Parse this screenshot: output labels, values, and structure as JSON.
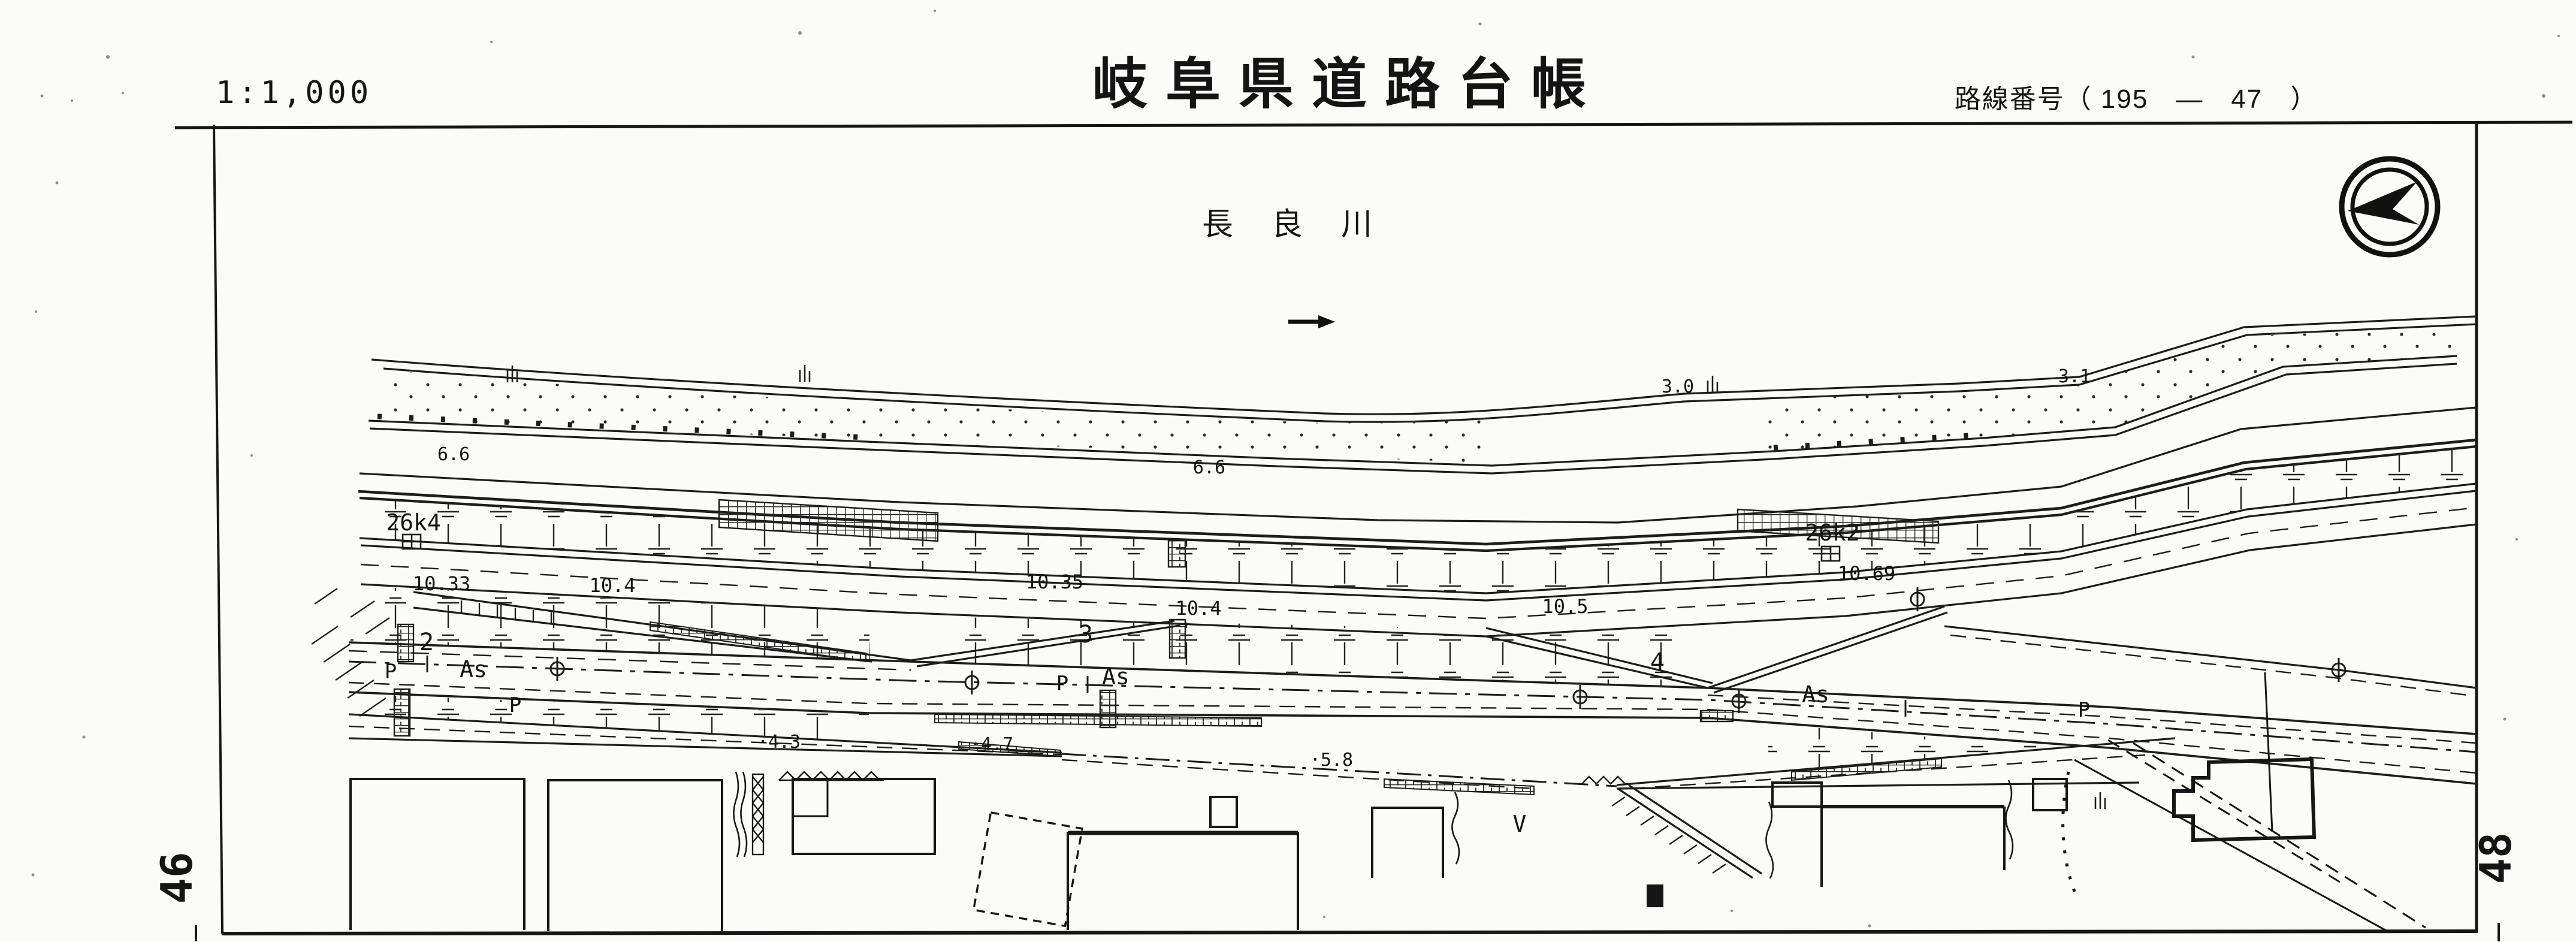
{
  "header": {
    "scale": "1:1,000",
    "title": "岐阜県道路台帳",
    "route_number": "路線番号（ 195　—　47　）"
  },
  "map": {
    "river_name": "長良川",
    "flow_arrow": "→",
    "compass": "north-west-pointer",
    "km_posts": [
      "26k4",
      "26k2"
    ],
    "road_widths": [
      "10.33",
      "10.4",
      "10.35",
      "10.4",
      "10.5",
      "10.69"
    ],
    "spot_elevations": [
      "3.0",
      "3.1",
      "6.6",
      "6.6",
      "·4.3",
      "·4.7",
      "·5.8"
    ],
    "ramp_numbers": [
      "2",
      "3",
      "4"
    ],
    "surface_labels": [
      "As",
      "As",
      "As"
    ],
    "parking_labels": [
      "P",
      "P",
      "P",
      "P"
    ],
    "v_mark": "V"
  },
  "footer": {
    "page_left": "46",
    "page_right": "48"
  }
}
